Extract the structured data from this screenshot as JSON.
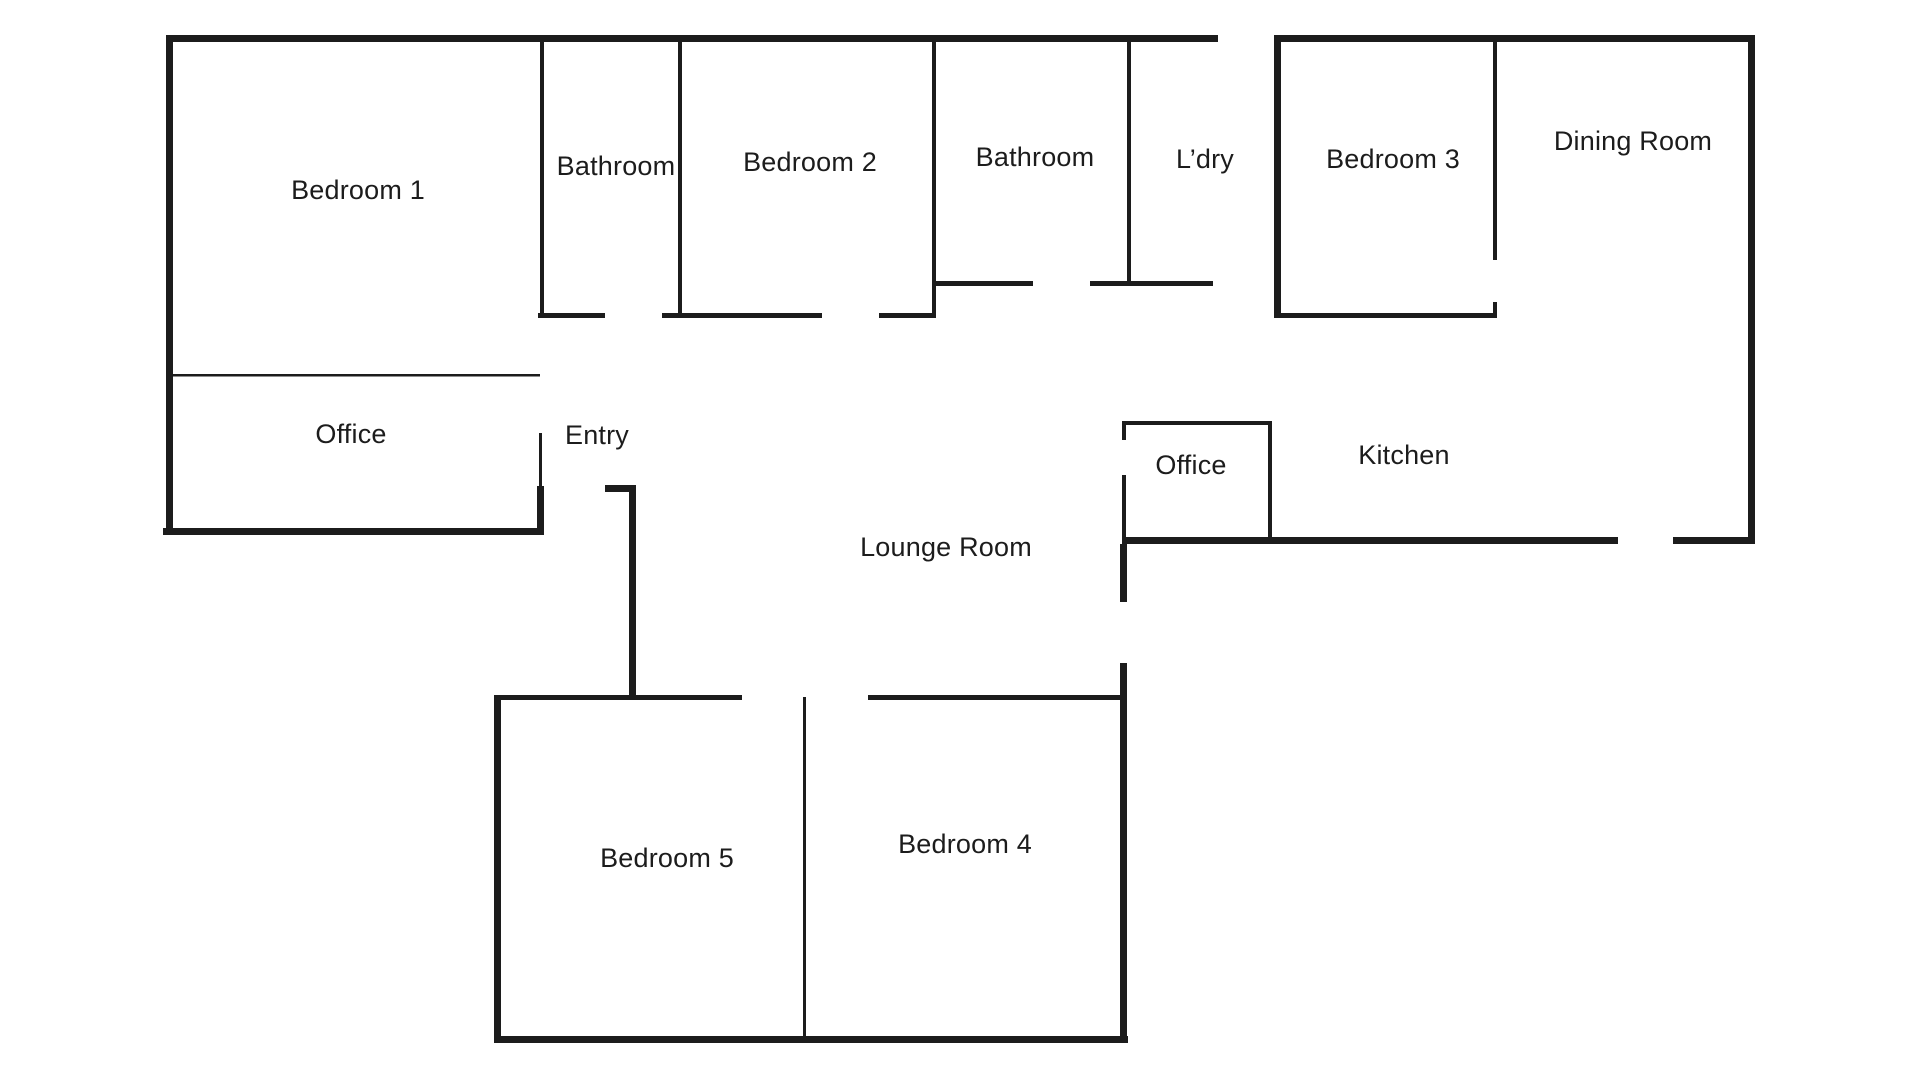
{
  "title": "Floor plan",
  "colors": {
    "wall": "#1c1c1c",
    "background": "#ffffff",
    "label_text": "#1c1c1c"
  },
  "rooms": [
    {
      "id": "bedroom-1",
      "label": "Bedroom 1",
      "x": 358,
      "y": 191
    },
    {
      "id": "bathroom-1",
      "label": "Bathroom",
      "x": 616,
      "y": 167
    },
    {
      "id": "bedroom-2",
      "label": "Bedroom 2",
      "x": 810,
      "y": 163
    },
    {
      "id": "bathroom-2",
      "label": "Bathroom",
      "x": 1035,
      "y": 158
    },
    {
      "id": "laundry",
      "label": "L’dry",
      "x": 1205,
      "y": 160
    },
    {
      "id": "bedroom-3",
      "label": "Bedroom 3",
      "x": 1393,
      "y": 160
    },
    {
      "id": "dining-room",
      "label": "Dining Room",
      "x": 1633,
      "y": 142
    },
    {
      "id": "office-left",
      "label": "Office",
      "x": 351,
      "y": 435
    },
    {
      "id": "entry",
      "label": "Entry",
      "x": 597,
      "y": 436
    },
    {
      "id": "lounge-room",
      "label": "Lounge Room",
      "x": 946,
      "y": 548
    },
    {
      "id": "office-right",
      "label": "Office",
      "x": 1191,
      "y": 466
    },
    {
      "id": "kitchen",
      "label": "Kitchen",
      "x": 1404,
      "y": 456
    },
    {
      "id": "bedroom-5",
      "label": "Bedroom 5",
      "x": 667,
      "y": 859
    },
    {
      "id": "bedroom-4",
      "label": "Bedroom 4",
      "x": 965,
      "y": 845
    }
  ]
}
